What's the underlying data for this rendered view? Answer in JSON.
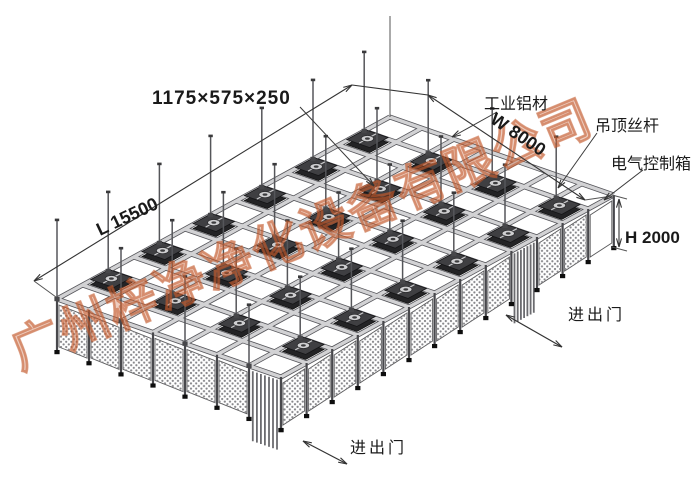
{
  "watermark": {
    "text": "广州梓净净化设备有限公司",
    "color": "#c25a2c"
  },
  "labels": {
    "ffu_size": "1175×575×250",
    "length": "L 15500",
    "width": "W 8000",
    "height": "H 2000",
    "industrial_aluminum": "工业铝材",
    "ceiling_rod": "吊顶丝杆",
    "control_box": "电气控制箱",
    "door_right": "进出门",
    "door_bottom": "进出门"
  },
  "structure": {
    "grid": {
      "cols": 13,
      "rows": 7
    },
    "ffu": {
      "count": 24,
      "cols": [
        1,
        3,
        5,
        7,
        9,
        11
      ],
      "rows": [
        0,
        2,
        4,
        6
      ]
    },
    "rods": {
      "cols": [
        0,
        2,
        4,
        6,
        8,
        10,
        12
      ],
      "rows": [
        0,
        2,
        4,
        6
      ]
    },
    "walls": {
      "left_bays": 7,
      "right_bays": 13,
      "left_door_bay": 6,
      "right_door_bay": 9,
      "control_panel_bay": 12
    }
  },
  "colors": {
    "background": "#ffffff",
    "beam_fill": "#d2d2d4",
    "beam_edge": "#55555a",
    "ffu_body": "#232325",
    "ffu_top": "#3f3f42",
    "dots": "#86868a",
    "line": "#333333",
    "label": "#1a1a1a",
    "watermark": "#c25a2c"
  }
}
